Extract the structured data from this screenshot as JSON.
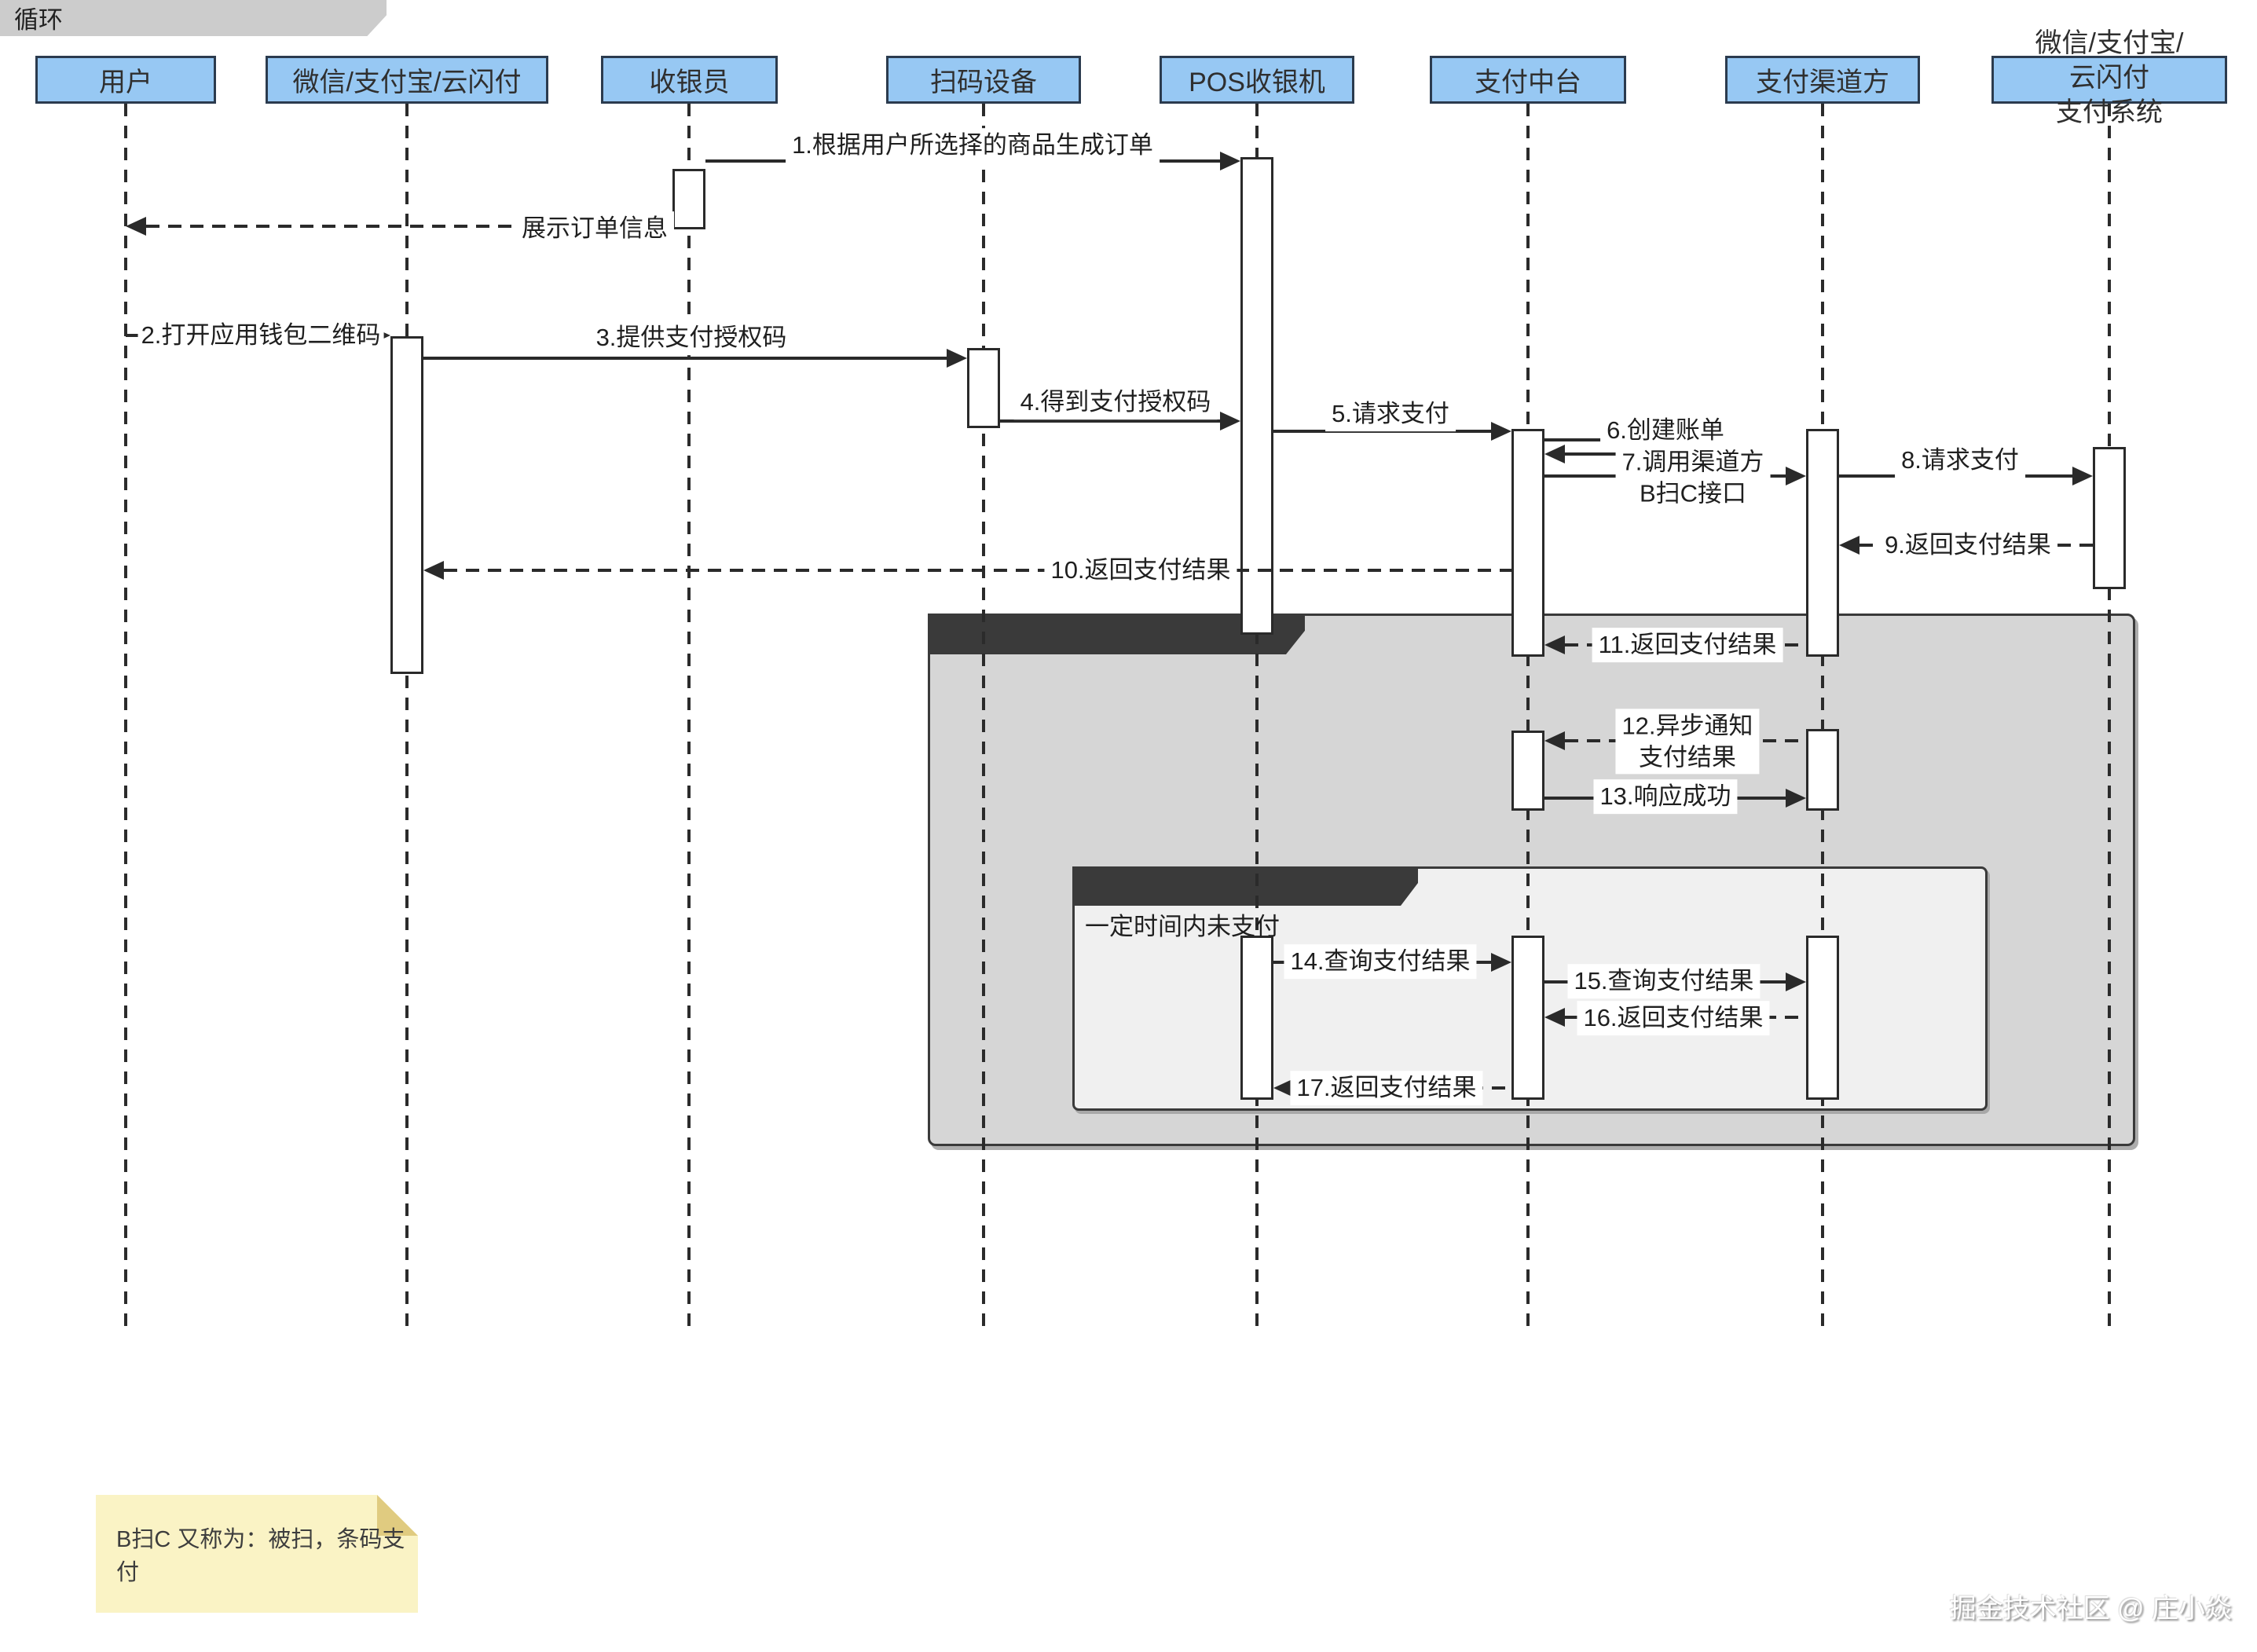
{
  "diagram_title": "B扫C 条码支付时序图",
  "colors": {
    "actor_fill": "#97C8F3",
    "actor_border": "#2B3B4E",
    "parallel_frame_fill": "#D6D6D6",
    "loop_frame_fill": "#F0F0F0",
    "note_fill": "#FAF3C5",
    "note_fold": "#E0CB80",
    "line": "#2A2A2A"
  },
  "actors": {
    "user": {
      "label": "用户"
    },
    "wallet_app": {
      "label": "微信/支付宝/云闪付"
    },
    "cashier": {
      "label": "收银员"
    },
    "scanner": {
      "label": "扫码设备"
    },
    "pos": {
      "label": "POS收银机"
    },
    "payment_platform": {
      "label": "支付中台"
    },
    "payment_channel": {
      "label": "支付渠道方"
    },
    "payment_system": {
      "line1": "微信/支付宝/",
      "line2": "云闪付",
      "line3": "支付系统"
    }
  },
  "messages": {
    "m1": {
      "label": "1.根据用户所选择的商品生成订单"
    },
    "r1": {
      "label": "展示订单信息"
    },
    "m2": {
      "label": "2.打开应用钱包二维码"
    },
    "m3": {
      "label": "3.提供支付授权码"
    },
    "m4": {
      "label": "4.得到支付授权码"
    },
    "m5": {
      "label": "5.请求支付"
    },
    "m6": {
      "label": "6.创建账单"
    },
    "m7": {
      "line1": "7.调用渠道方",
      "line2": "B扫C接口"
    },
    "m8": {
      "label": "8.请求支付"
    },
    "m9": {
      "label": "9.返回支付结果"
    },
    "m10": {
      "label": "10.返回支付结果"
    },
    "m11": {
      "label": "11.返回支付结果"
    },
    "m12": {
      "line1": "12.异步通知",
      "line2": "支付结果"
    },
    "m13": {
      "label": "13.响应成功"
    },
    "m14": {
      "label": "14.查询支付结果"
    },
    "m15": {
      "label": "15.查询支付结果"
    },
    "m16": {
      "label": "16.返回支付结果"
    },
    "m17": {
      "label": "17.返回支付结果"
    }
  },
  "frames": {
    "parallel": {
      "label": "并行处理"
    },
    "loop": {
      "label": "循环",
      "guard": "一定时间内未支付"
    }
  },
  "note": {
    "text": "B扫C 又称为：被扫，条码支付"
  },
  "watermark": {
    "text": "掘金技术社区 @ 庄小焱"
  }
}
